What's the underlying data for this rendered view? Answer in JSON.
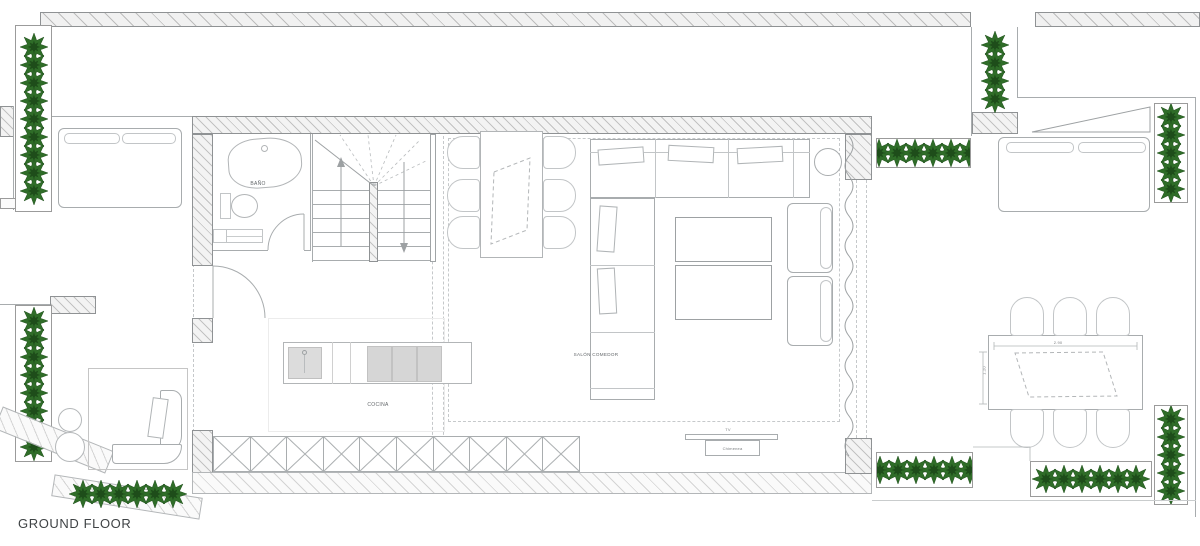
{
  "plan": {
    "title": "GROUND FLOOR",
    "rooms": {
      "bathroom": "BAÑO",
      "kitchen": "COCINA",
      "living_dining": "SALÓN COMEDOR"
    },
    "annotations": {
      "tv": "TV",
      "fireplace": "Chimenea"
    },
    "dimensions": {
      "terrace_table_width": "2.90",
      "terrace_table_depth": "1.20"
    },
    "colors": {
      "plant_green": "#2f6d28",
      "plant_green_dark": "#1e4d1a",
      "wall_hatch": "#c2c2c2",
      "furniture_line": "#a8acae",
      "label_text": "#63676a",
      "title_text": "#3f4345"
    }
  }
}
